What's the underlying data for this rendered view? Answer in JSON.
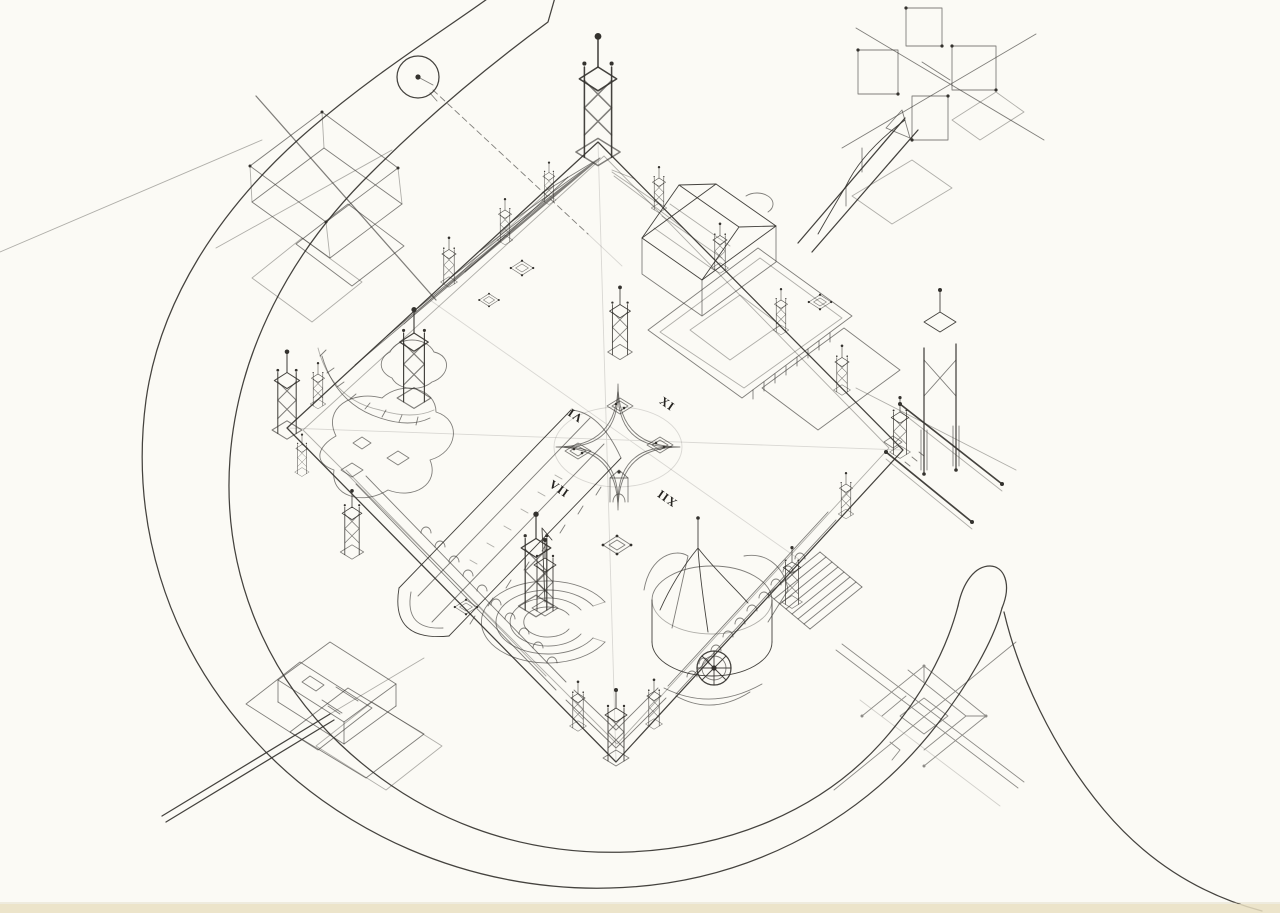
{
  "drawing": {
    "kind": "axonometric architectural line drawing",
    "numerals": [
      {
        "label": "VI"
      },
      {
        "label": "XI"
      },
      {
        "label": "XII"
      },
      {
        "label": "VII"
      }
    ],
    "colors": {
      "paper": "#fbfaf5",
      "ink": "#34322e",
      "scan_edge_strip": "#e9dfc2"
    }
  }
}
